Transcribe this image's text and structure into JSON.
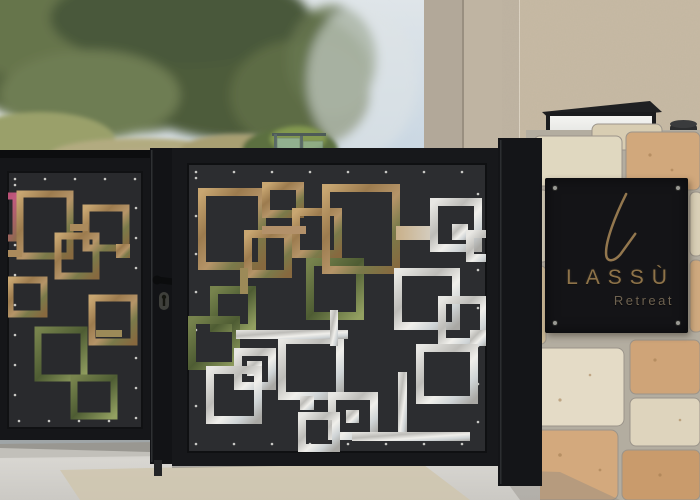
{
  "scene": {
    "type": "photograph",
    "description": "Black laser-cut metal entrance gate with interlocking square pattern, stone pillar carrying a black LASSÙ Retreat sign with a wall light on top, olive trees, hazy sky and a modern stucco building in the background, concrete pavement in the foreground"
  },
  "sign": {
    "logo_letter": "L",
    "title": "LASSÙ",
    "subtitle": "Retreat",
    "background_color": "#141417",
    "text_color": "#8e7349",
    "subtitle_color": "#6e6250"
  },
  "palette": {
    "sky": "#cbd8e3",
    "olive_trees": "#57653f",
    "grass": "#9aa06b",
    "building_concrete": "#b2a899",
    "building_stucco": "#c7baa4",
    "gate_frame": "#17181b",
    "gate_panel": "#2c2d30",
    "cutout_stone": "#b3916a",
    "cutout_plants": "#5e6c3d",
    "cutout_steel": "#d5d3cd",
    "cutout_flowers": "#b2486e",
    "pillar_stone_cream": "#e0d8c0",
    "pillar_stone_rust": "#d1a87c",
    "pillar_mortar": "#b3ada0",
    "pavement": "#d8d6d1",
    "pavement_patch": "#cfc5ae"
  },
  "objects": {
    "left_fence_panel": "laser-cut fence panel",
    "main_gate_panel": "laser-cut double gate panel",
    "gate_handle": "gate lever handle",
    "keyhole": "gate keyhole",
    "stone_pillar": "rough stone pillar",
    "retreat_sign": "LASSÙ Retreat entrance sign",
    "wall_light": "rectangular wall light fixture",
    "glass_railing": "glass balustrade fragment",
    "pavement": "concrete pavement"
  }
}
